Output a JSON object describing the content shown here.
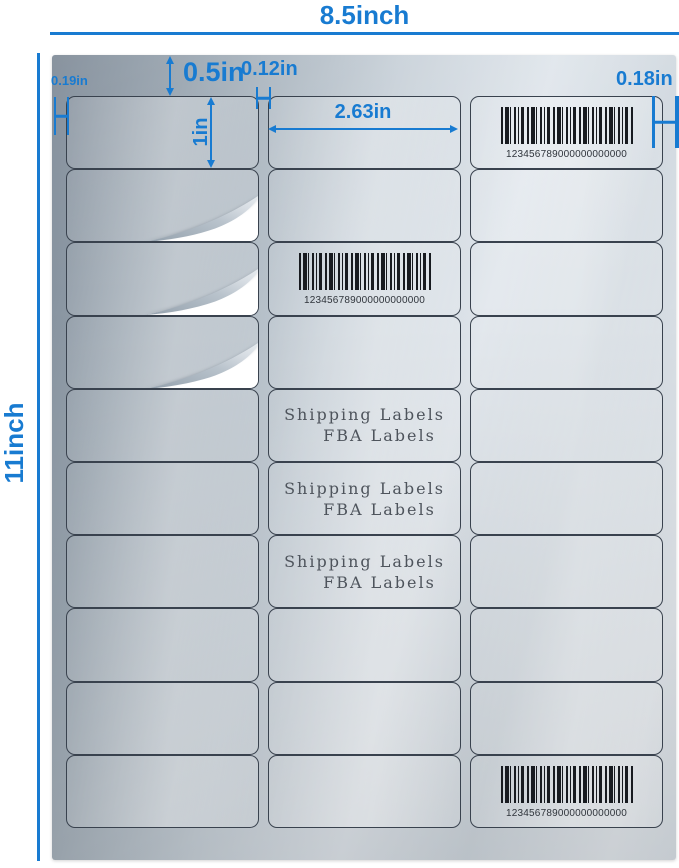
{
  "colors": {
    "accent_blue": "#187bd1",
    "label_border": "#39424e",
    "barcode_bar": "#181b20",
    "sheet_silver_dark": "#7b8794",
    "sheet_silver_light": "#e2e7ec"
  },
  "dimensions": {
    "sheet_width": "8.5inch",
    "sheet_height": "11inch",
    "top_margin": "0.5in",
    "column_gap": "0.12in",
    "right_margin": "0.18in",
    "left_margin": "0.19in",
    "label_height": "1in",
    "label_width": "2.63in"
  },
  "sheet": {
    "rows": 10,
    "columns": 3,
    "labels_per_sheet": 30,
    "barcode_value": "123456789000000000000",
    "label_text": {
      "line1": "Shipping Labels",
      "line2": "FBA Labels"
    }
  }
}
